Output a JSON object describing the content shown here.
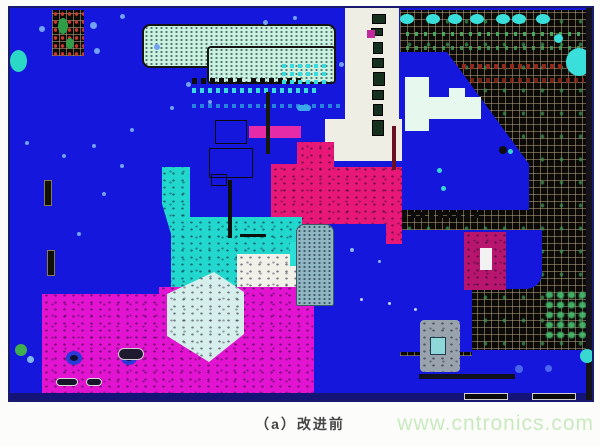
{
  "figure": {
    "caption": "（a）改进前",
    "watermark": "www.cntronics.com"
  },
  "palette": {
    "board_blue": "#1518dc",
    "border_navy": "#1b1b6e",
    "pour_pink": "#e81878",
    "pour_magenta": "#e214d2",
    "pour_cyan": "#22d8ce",
    "pale_mint": "#c9f2e0",
    "grid_black": "#0b0a07",
    "silk_white": "#efeee5",
    "watermark_green": "#c9eabf"
  },
  "board": {
    "shapes": [
      {
        "name": "ground-grid-region",
        "cls": "grid-bg",
        "x": 390,
        "y": 2,
        "w": 192,
        "h": 346
      },
      {
        "name": "grid-pad-row-green",
        "cls": "dash-green",
        "x": 396,
        "y": 24,
        "w": 178,
        "h": 4
      },
      {
        "name": "grid-pad-row-green",
        "cls": "dash-green",
        "x": 396,
        "y": 38,
        "w": 178,
        "h": 4,
        "opacity": 0.8
      },
      {
        "name": "grid-pad-row-red",
        "cls": "dash-red",
        "x": 396,
        "y": 56,
        "w": 178,
        "h": 5
      },
      {
        "name": "grid-pad-row-red",
        "cls": "dash-red",
        "x": 420,
        "y": 70,
        "w": 154,
        "h": 5,
        "opacity": 0.8
      },
      {
        "name": "blue-pour-upper-right",
        "x": 390,
        "y": 44,
        "w": 130,
        "h": 158,
        "bg": "#1518dc",
        "clip": "polygon(0px 0px, 47px 0px, 129px 112px, 129px 158px, 0px 158px)"
      },
      {
        "name": "blue-pour-mid-right",
        "x": 390,
        "y": 222,
        "w": 142,
        "h": 59,
        "bg": "#1518dc",
        "r": "0 0 16px 0"
      },
      {
        "name": "blue-pour-mid-right-lower",
        "x": 390,
        "y": 222,
        "w": 72,
        "h": 122,
        "bg": "#1518dc"
      },
      {
        "name": "blue-pour-bottom-right",
        "x": 462,
        "y": 342,
        "w": 120,
        "h": 50,
        "bg": "#1518dc"
      },
      {
        "name": "pad-row-black",
        "cls": "dash-black",
        "x": 392,
        "y": 204,
        "w": 80,
        "h": 6
      },
      {
        "name": "cyan-pad",
        "x": 390,
        "y": 6,
        "w": 14,
        "h": 10,
        "bg": "#3adfdb",
        "r": "50%"
      },
      {
        "name": "cyan-pad",
        "x": 416,
        "y": 6,
        "w": 14,
        "h": 10,
        "bg": "#3adfdb",
        "r": "50%"
      },
      {
        "name": "cyan-pad",
        "x": 438,
        "y": 6,
        "w": 14,
        "h": 10,
        "bg": "#3adfdb",
        "r": "50%"
      },
      {
        "name": "cyan-pad",
        "x": 460,
        "y": 6,
        "w": 14,
        "h": 10,
        "bg": "#3adfdb",
        "r": "50%"
      },
      {
        "name": "cyan-pad",
        "x": 486,
        "y": 6,
        "w": 14,
        "h": 10,
        "bg": "#3adfdb",
        "r": "50%"
      },
      {
        "name": "cyan-pad",
        "x": 502,
        "y": 6,
        "w": 14,
        "h": 10,
        "bg": "#3adfdb",
        "r": "50%"
      },
      {
        "name": "cyan-pad",
        "x": 526,
        "y": 6,
        "w": 14,
        "h": 10,
        "bg": "#3adfdb",
        "r": "50%"
      },
      {
        "name": "cyan-pad-large",
        "x": 556,
        "y": 40,
        "w": 26,
        "h": 28,
        "bg": "#3adfdb",
        "r": "50%"
      },
      {
        "name": "cyan-pad-small",
        "x": 544,
        "y": 26,
        "w": 9,
        "h": 9,
        "bg": "#3adfdb",
        "r": "50%"
      },
      {
        "name": "silk-strip",
        "x": 335,
        "y": 0,
        "w": 54,
        "h": 134,
        "bg": "#efeee5"
      },
      {
        "name": "silk-strip-foot",
        "x": 315,
        "y": 111,
        "w": 77,
        "h": 42,
        "bg": "#efeee5"
      },
      {
        "name": "strip-component",
        "x": 362,
        "y": 6,
        "w": 14,
        "h": 10,
        "bg": "#16301e",
        "border": "1px solid #000"
      },
      {
        "name": "strip-component",
        "x": 361,
        "y": 20,
        "w": 12,
        "h": 8,
        "bg": "#16301e",
        "border": "1px solid #000"
      },
      {
        "name": "strip-component",
        "x": 363,
        "y": 34,
        "w": 10,
        "h": 12,
        "bg": "#16301e",
        "border": "1px solid #000"
      },
      {
        "name": "strip-component",
        "x": 362,
        "y": 50,
        "w": 12,
        "h": 10,
        "bg": "#16301e",
        "border": "1px solid #000"
      },
      {
        "name": "strip-component",
        "x": 363,
        "y": 64,
        "w": 12,
        "h": 14,
        "bg": "#16301e",
        "border": "1px solid #000"
      },
      {
        "name": "strip-component",
        "x": 362,
        "y": 82,
        "w": 12,
        "h": 10,
        "bg": "#16301e",
        "border": "1px solid #000"
      },
      {
        "name": "strip-component",
        "x": 363,
        "y": 96,
        "w": 10,
        "h": 12,
        "bg": "#16301e",
        "border": "1px solid #000"
      },
      {
        "name": "strip-component",
        "x": 362,
        "y": 112,
        "w": 12,
        "h": 16,
        "bg": "#16301e",
        "border": "1px solid #000"
      },
      {
        "name": "strip-component-magenta",
        "x": 357,
        "y": 22,
        "w": 8,
        "h": 8,
        "bg": "#c22a9e"
      },
      {
        "name": "silk-patch",
        "x": 395,
        "y": 69,
        "w": 24,
        "h": 54,
        "bg": "#e7f8ee"
      },
      {
        "name": "silk-patch",
        "x": 419,
        "y": 89,
        "w": 52,
        "h": 22,
        "bg": "#e7f8ee"
      },
      {
        "name": "silk-patch",
        "x": 439,
        "y": 80,
        "w": 16,
        "h": 10,
        "bg": "#e7f8ee"
      },
      {
        "name": "component-crimson",
        "cls": "speckle",
        "x": 454,
        "y": 224,
        "w": 42,
        "h": 58,
        "bg": "#b8156f"
      },
      {
        "name": "component-crimson-center",
        "x": 470,
        "y": 240,
        "w": 12,
        "h": 22,
        "bg": "#f2f2f2"
      },
      {
        "name": "grid-green-component",
        "cls": "green-blobs",
        "x": 534,
        "y": 282,
        "w": 44,
        "h": 50
      },
      {
        "name": "connector-top",
        "cls": "dots-fine",
        "x": 132,
        "y": 16,
        "w": 194,
        "h": 44,
        "bg": "#c9f2e0",
        "border": "2px solid #141414",
        "r": "8px"
      },
      {
        "name": "connector-top-lower",
        "cls": "dots-fine",
        "x": 197,
        "y": 38,
        "w": 129,
        "h": 38,
        "bg": "#c9f2e0",
        "border": "2px solid #141414",
        "r": "4px"
      },
      {
        "name": "pad-row-black",
        "cls": "dash-black",
        "x": 182,
        "y": 70,
        "w": 54,
        "h": 6
      },
      {
        "name": "pad-row-black",
        "cls": "dash-black",
        "x": 241,
        "y": 70,
        "w": 52,
        "h": 6
      },
      {
        "name": "pad-row-cyan",
        "cls": "dash-cyan",
        "x": 182,
        "y": 80,
        "w": 124,
        "h": 5
      },
      {
        "name": "pad-row-cyan",
        "cls": "dash-cyan",
        "x": 182,
        "y": 96,
        "w": 148,
        "h": 4,
        "opacity": 0.55
      },
      {
        "name": "pad-row-cyan",
        "cls": "dash-cyan",
        "x": 272,
        "y": 56,
        "w": 48,
        "h": 4
      },
      {
        "name": "pad-row-cyan",
        "cls": "dash-cyan",
        "x": 272,
        "y": 64,
        "w": 48,
        "h": 4
      },
      {
        "name": "pad-row-cyan",
        "cls": "dash-cyan",
        "x": 272,
        "y": 72,
        "w": 48,
        "h": 4
      },
      {
        "name": "pad-pill",
        "x": 287,
        "y": 97,
        "w": 14,
        "h": 6,
        "bg": "#38a8e8",
        "r": "3px"
      },
      {
        "name": "bga-component",
        "cls": "bga",
        "x": 42,
        "y": 2,
        "w": 32,
        "h": 46
      },
      {
        "name": "bga-green-blob",
        "x": 48,
        "y": 10,
        "w": 10,
        "h": 16,
        "bg": "#2f9e47",
        "r": "50%"
      },
      {
        "name": "bga-green-blob",
        "x": 56,
        "y": 30,
        "w": 8,
        "h": 11,
        "bg": "#2f9e47",
        "r": "50%"
      },
      {
        "name": "cyan-pad-left",
        "x": 0,
        "y": 42,
        "w": 17,
        "h": 22,
        "bg": "#2bd8c6",
        "r": "50%"
      },
      {
        "name": "resistor-footprint",
        "x": 34,
        "y": 172,
        "w": 8,
        "h": 26,
        "bg": "#101008",
        "border": "1px solid #8a7a4a"
      },
      {
        "name": "resistor-footprint",
        "x": 37,
        "y": 242,
        "w": 8,
        "h": 26,
        "bg": "#101008",
        "border": "1px solid #8a7a4a"
      },
      {
        "name": "trace-magenta-bar",
        "x": 239,
        "y": 118,
        "w": 52,
        "h": 12,
        "bg": "#e52ba8"
      },
      {
        "name": "copper-pour-pink",
        "cls": "speckle",
        "x": 261,
        "y": 130,
        "w": 132,
        "h": 106,
        "bg": "#e81878",
        "clip": "polygon(26px 4px, 63px 4px, 63px 29px, 131px 29px, 131px 106px, 115px 106px, 115px 86px, 0px 86px, 0px 26px, 26px 26px)"
      },
      {
        "name": "trace-maroon",
        "x": 382,
        "y": 118,
        "w": 4,
        "h": 44,
        "bg": "#6a1025"
      },
      {
        "name": "copper-pour-cyan",
        "cls": "speckle",
        "x": 150,
        "y": 155,
        "w": 144,
        "h": 134,
        "bg": "#22d8ce",
        "clip": "polygon(2px 4px, 30px 4px, 30px 54px, 142px 54px, 142px 133px, 11px 133px, 11px 71px, 2px 41px)"
      },
      {
        "name": "silk-band",
        "cls": "speckle",
        "x": 227,
        "y": 246,
        "w": 72,
        "h": 40,
        "bg": "#f1f1ea"
      },
      {
        "name": "cyan-pad-rect",
        "x": 280,
        "y": 234,
        "w": 12,
        "h": 24,
        "bg": "#28e0d6"
      },
      {
        "name": "footprint-outline",
        "x": 205,
        "y": 112,
        "w": 32,
        "h": 24,
        "border": "1px solid #0b0b0b"
      },
      {
        "name": "footprint-outline",
        "x": 199,
        "y": 140,
        "w": 44,
        "h": 30,
        "border": "1px solid #0b0b0b"
      },
      {
        "name": "footprint-outline",
        "x": 201,
        "y": 166,
        "w": 16,
        "h": 12,
        "border": "1px solid #0b0b0b"
      },
      {
        "name": "footprint-trace",
        "x": 218,
        "y": 172,
        "w": 4,
        "h": 58,
        "bg": "#0c100a"
      },
      {
        "name": "footprint-trace",
        "x": 256,
        "y": 84,
        "w": 4,
        "h": 62,
        "bg": "#14180e"
      },
      {
        "name": "footprint-trace",
        "x": 230,
        "y": 226,
        "w": 26,
        "h": 3,
        "bg": "#0c100a"
      },
      {
        "name": "copper-pour-magenta",
        "cls": "speckle",
        "x": 32,
        "y": 277,
        "w": 272,
        "h": 112,
        "bg": "#e214d2",
        "clip": "polygon(0px 9px, 117px 9px, 117px 2px, 272px 2px, 272px 112px, 0px 112px)"
      },
      {
        "name": "copper-pour-pale",
        "cls": "speckle",
        "x": 151,
        "y": 260,
        "w": 85,
        "h": 96,
        "bg": "#d6efec",
        "clip": "polygon(6px 26px, 53px 4px, 83px 24px, 83px 66px, 48px 94px, 6px 68px)"
      },
      {
        "name": "via",
        "x": 56,
        "y": 343,
        "w": 16,
        "h": 14,
        "bg": "#0e1030",
        "border": "4px solid #2a3ad8",
        "r": "50%"
      },
      {
        "name": "via",
        "x": 111,
        "y": 343,
        "w": 16,
        "h": 14,
        "bg": "#0e1030",
        "border": "4px solid #2a3ad8",
        "r": "50%"
      },
      {
        "name": "pad-pill-dark",
        "x": 46,
        "y": 370,
        "w": 22,
        "h": 8,
        "bg": "#16162a",
        "border": "1px solid #d8d8d8",
        "r": "4px"
      },
      {
        "name": "pad-pill-dark",
        "x": 76,
        "y": 370,
        "w": 16,
        "h": 8,
        "bg": "#16162a",
        "border": "1px solid #d8d8d8",
        "r": "4px"
      },
      {
        "name": "pad-pill-dark",
        "x": 108,
        "y": 340,
        "w": 26,
        "h": 12,
        "bg": "#201a30",
        "border": "1px solid #cfcfcf",
        "r": "6px"
      },
      {
        "name": "connector-gray",
        "cls": "dots-fine",
        "x": 286,
        "y": 216,
        "w": 38,
        "h": 82,
        "bg": "#90b6c4",
        "border": "1px solid #3a5a66",
        "r": "8px 8px 2px 2px"
      },
      {
        "name": "component-gray",
        "cls": "speckle",
        "x": 410,
        "y": 312,
        "w": 40,
        "h": 52,
        "bg": "#99a3ad",
        "r": "4px"
      },
      {
        "name": "component-gray-center",
        "x": 420,
        "y": 329,
        "w": 16,
        "h": 18,
        "bg": "#8fd8da",
        "border": "1px solid #223a4a"
      },
      {
        "name": "trace-dark",
        "x": 409,
        "y": 366,
        "w": 96,
        "h": 5,
        "bg": "#10101e"
      },
      {
        "name": "board-bottom-edge",
        "x": 0,
        "y": 385,
        "w": 582,
        "h": 7,
        "bg": "#141378"
      },
      {
        "name": "edge-pad",
        "x": 454,
        "y": 385,
        "w": 44,
        "h": 7,
        "bg": "#0a0a0a",
        "border": "1px solid #cfcfcf"
      },
      {
        "name": "edge-pad",
        "x": 522,
        "y": 385,
        "w": 44,
        "h": 7,
        "bg": "#0a0a0a",
        "border": "1px solid #cfcfcf"
      },
      {
        "name": "board-right-edge",
        "x": 576,
        "y": 0,
        "w": 6,
        "h": 392,
        "bg": "#16121c"
      }
    ],
    "dots": [
      {
        "x": 29,
        "y": 18,
        "s": 6
      },
      {
        "x": 80,
        "y": 14,
        "s": 7
      },
      {
        "x": 84,
        "y": 40,
        "s": 6
      },
      {
        "x": 110,
        "y": 6,
        "s": 5
      },
      {
        "x": 144,
        "y": 36,
        "s": 6
      },
      {
        "x": 176,
        "y": 74,
        "s": 5
      },
      {
        "x": 253,
        "y": 12,
        "s": 5
      },
      {
        "x": 283,
        "y": 8,
        "s": 4
      },
      {
        "x": 329,
        "y": 54,
        "s": 5
      },
      {
        "x": 15,
        "y": 133,
        "s": 4
      },
      {
        "x": 52,
        "y": 146,
        "s": 4
      },
      {
        "x": 82,
        "y": 136,
        "s": 4
      },
      {
        "x": 110,
        "y": 156,
        "s": 4
      },
      {
        "x": 92,
        "y": 184,
        "s": 4
      },
      {
        "x": 67,
        "y": 224,
        "s": 4
      },
      {
        "x": 120,
        "y": 120,
        "s": 4
      },
      {
        "x": 160,
        "y": 98,
        "s": 4
      },
      {
        "x": 198,
        "y": 92,
        "s": 4
      },
      {
        "x": 5,
        "y": 336,
        "s": 12,
        "c": "#3fae4f"
      },
      {
        "x": 17,
        "y": 348,
        "s": 7,
        "c": "#7fb8e8"
      },
      {
        "x": 505,
        "y": 357,
        "s": 8,
        "c": "#4a66ee"
      },
      {
        "x": 535,
        "y": 357,
        "s": 7,
        "c": "#4a66ee"
      },
      {
        "x": 570,
        "y": 341,
        "s": 14,
        "c": "#38d8d0"
      },
      {
        "x": 427,
        "y": 160,
        "s": 5,
        "c": "#38d8d0"
      },
      {
        "x": 431,
        "y": 178,
        "s": 5,
        "c": "#38d8d0"
      },
      {
        "x": 489,
        "y": 138,
        "s": 8,
        "c": "#0d0d0d"
      },
      {
        "x": 498,
        "y": 141,
        "s": 5,
        "c": "#38d8d0"
      },
      {
        "x": 350,
        "y": 290,
        "s": 3,
        "c": "#c8d4f8"
      },
      {
        "x": 378,
        "y": 294,
        "s": 3,
        "c": "#c8d4f8"
      },
      {
        "x": 404,
        "y": 300,
        "s": 3,
        "c": "#c8d4f8"
      },
      {
        "x": 340,
        "y": 240,
        "s": 4,
        "c": "#8fb8f8"
      },
      {
        "x": 368,
        "y": 252,
        "s": 3,
        "c": "#8fb8f8"
      }
    ]
  }
}
